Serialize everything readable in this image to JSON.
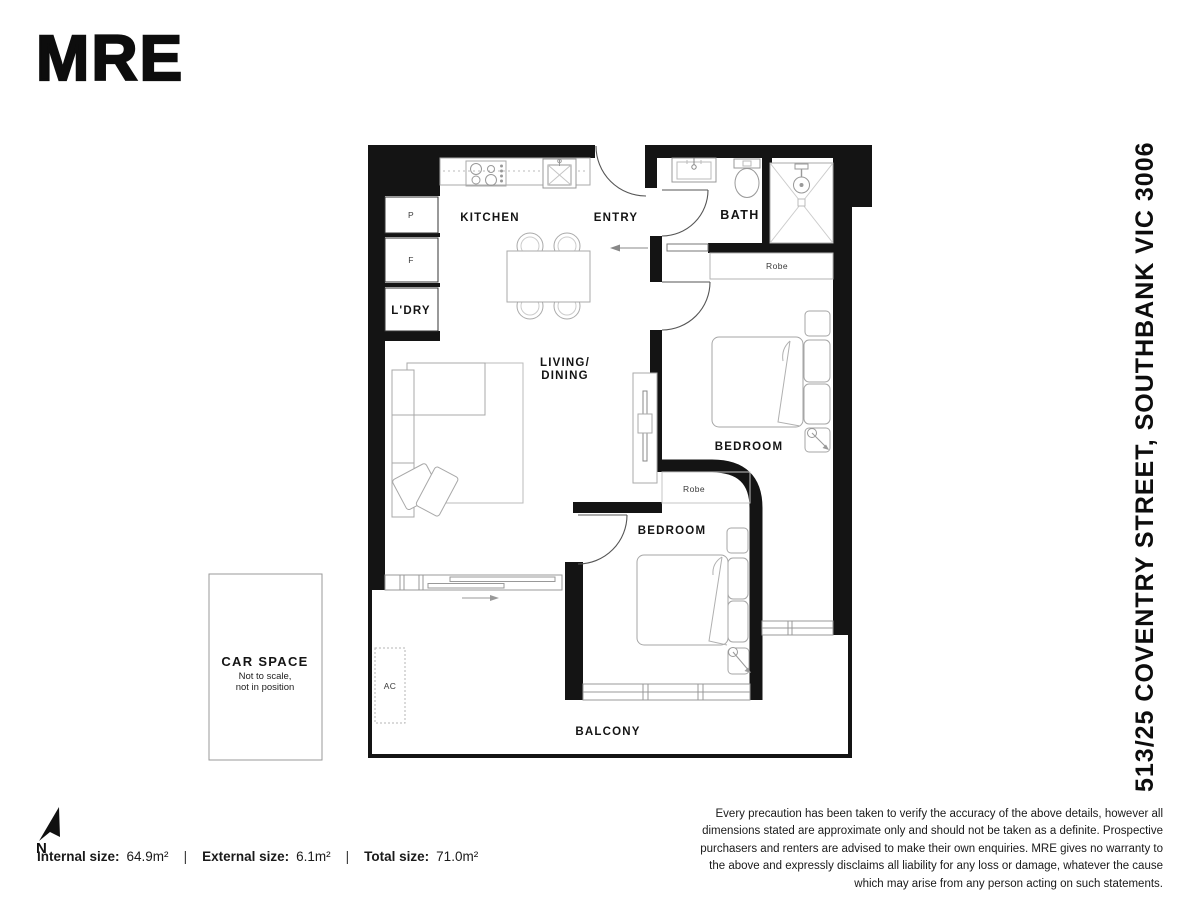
{
  "brand": {
    "logo": "MRE"
  },
  "address": "513/25 COVENTRY STREET, SOUTHBANK VIC 3006",
  "rooms": {
    "kitchen": "KITCHEN",
    "entry": "ENTRY",
    "bath": "BATH",
    "living_line1": "LIVING/",
    "living_line2": "DINING",
    "bedroom1": "BEDROOM",
    "bedroom2": "BEDROOM",
    "balcony": "BALCONY",
    "laundry": "L'DRY"
  },
  "fixtures": {
    "pantry": "P",
    "fridge": "F",
    "robe_bed1": "Robe",
    "robe_bed2": "Robe",
    "ac": "AC"
  },
  "car_space": {
    "title": "CAR SPACE",
    "note1": "Not to scale,",
    "note2": "not in position"
  },
  "compass": {
    "north": "N"
  },
  "sizes": {
    "internal_label": "Internal size:",
    "internal_value": "64.9m²",
    "external_label": "External size:",
    "external_value": "6.1m²",
    "total_label": "Total size:",
    "total_value": "71.0m²",
    "divider": "|"
  },
  "disclaimer": "Every precaution has been taken to verify the accuracy of the above details, however all dimensions stated are approximate only and should not be taken as a definite. Prospective purchasers and renters are advised to make their own enquiries. MRE gives no warranty to the above and expressly disclaims all liability for any loss or damage, whatever the cause which may arise from any person acting on such statements.",
  "colors": {
    "wall": "#141414",
    "furniture_line": "#a6a6a6",
    "text": "#141414"
  }
}
